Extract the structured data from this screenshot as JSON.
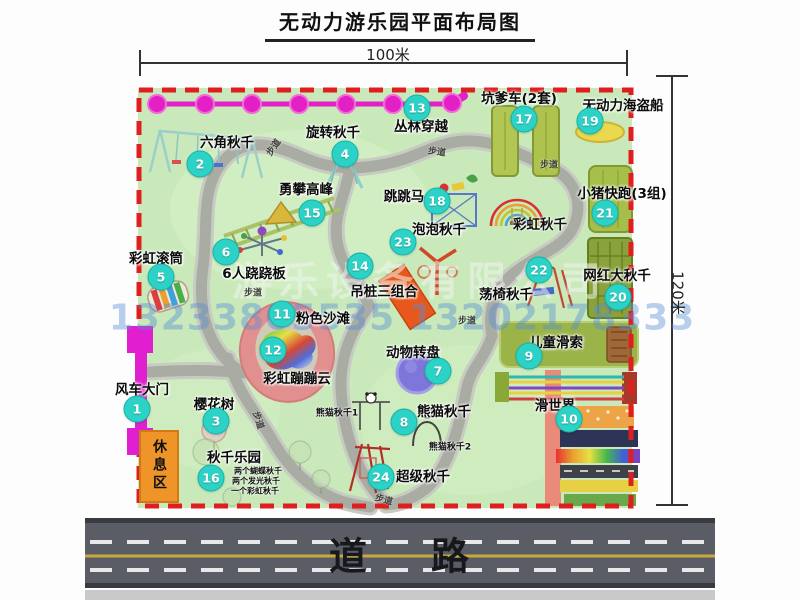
{
  "title": "无动力游乐园平面布局图",
  "dimensions": {
    "width_label": "100米",
    "height_label": "120米"
  },
  "watermark": {
    "company": "游乐设备有限公司",
    "phone": "13233805535 13202178333"
  },
  "road": {
    "label": "道路"
  },
  "colors": {
    "map_green": "#c9e9bb",
    "border_red": "#df1f1f",
    "badge_teal": "#2bd2c5",
    "zipline_pink": "#e320c6",
    "gate_magenta": "#e020d0",
    "rest_orange": "#ef9428",
    "path_gray": "#a8aca3",
    "road_gray": "#5b5d66"
  },
  "map": {
    "attractions": [
      {
        "num": 1,
        "name": "风车大门",
        "lx": 142,
        "ly": 388,
        "bx": 137,
        "by": 409
      },
      {
        "num": 2,
        "name": "六角秋千",
        "lx": 227,
        "ly": 141,
        "bx": 200,
        "by": 164
      },
      {
        "num": 3,
        "name": "樱花树",
        "lx": 214,
        "ly": 403,
        "bx": 216,
        "by": 421
      },
      {
        "num": 4,
        "name": "旋转秋千",
        "lx": 333,
        "ly": 131,
        "bx": 345,
        "by": 154
      },
      {
        "num": 5,
        "name": "彩虹滚筒",
        "lx": 156,
        "ly": 257,
        "bx": 161,
        "by": 277
      },
      {
        "num": 6,
        "name": "6人跷跷板",
        "lx": 254,
        "ly": 272,
        "bx": 226,
        "by": 252
      },
      {
        "num": 7,
        "name": "动物转盘",
        "lx": 413,
        "ly": 351,
        "bx": 438,
        "by": 371
      },
      {
        "num": 8,
        "name": "熊猫秋千",
        "lx": 444,
        "ly": 410,
        "bx": 404,
        "by": 422
      },
      {
        "num": 9,
        "name": "儿童滑索",
        "lx": 556,
        "ly": 341,
        "bx": 529,
        "by": 356
      },
      {
        "num": 10,
        "name": "滑世界",
        "lx": 555,
        "ly": 404,
        "bx": 569,
        "by": 419
      },
      {
        "num": 11,
        "name": "粉色沙滩",
        "lx": 323,
        "ly": 317,
        "bx": 282,
        "by": 314
      },
      {
        "num": 12,
        "name": "彩虹蹦蹦云",
        "lx": 297,
        "ly": 377,
        "bx": 273,
        "by": 350
      },
      {
        "num": 13,
        "name": "丛林穿越",
        "lx": 421,
        "ly": 125,
        "bx": 417,
        "by": 108
      },
      {
        "num": 14,
        "name": "吊桩三组合",
        "lx": 384,
        "ly": 290,
        "bx": 360,
        "by": 266
      },
      {
        "num": 15,
        "name": "勇攀高峰",
        "lx": 306,
        "ly": 188,
        "bx": 312,
        "by": 213
      },
      {
        "num": 16,
        "name": "秋千乐园",
        "lx": 234,
        "ly": 456,
        "bx": 211,
        "by": 478
      },
      {
        "num": 17,
        "name": "坑爹车(2套)",
        "lx": 519,
        "ly": 97,
        "bx": 524,
        "by": 119
      },
      {
        "num": 18,
        "name": "跳跳马",
        "lx": 404,
        "ly": 195,
        "bx": 437,
        "by": 201
      },
      {
        "num": 19,
        "name": "无动力海盗船",
        "lx": 623,
        "ly": 104,
        "bx": 590,
        "by": 121
      },
      {
        "num": 20,
        "name": "网红大秋千",
        "lx": 617,
        "ly": 274,
        "bx": 618,
        "by": 297
      },
      {
        "num": 21,
        "name": "小猪快跑(3组)",
        "lx": 622,
        "ly": 192,
        "bx": 605,
        "by": 213
      },
      {
        "num": 22,
        "name": "荡椅秋千",
        "lx": 506,
        "ly": 293,
        "bx": 539,
        "by": 270
      },
      {
        "num": 23,
        "name": "泡泡秋千",
        "lx": 439,
        "ly": 228,
        "bx": 403,
        "by": 242
      },
      {
        "num": 24,
        "name": "超级秋千",
        "lx": 423,
        "ly": 475,
        "bx": 381,
        "by": 477
      }
    ],
    "sub_labels": [
      {
        "text": "彩虹秋千",
        "x": 540,
        "y": 223,
        "size": 13.5
      },
      {
        "text": "熊猫秋千1",
        "x": 337,
        "y": 412,
        "size": 9
      },
      {
        "text": "熊猫秋千2",
        "x": 450,
        "y": 446,
        "size": 9
      },
      {
        "text": "两个蝴蝶秋千",
        "x": 258,
        "y": 471,
        "size": 8
      },
      {
        "text": "两个发光秋千",
        "x": 256,
        "y": 481,
        "size": 8
      },
      {
        "text": "一个彩虹秋千",
        "x": 255,
        "y": 491,
        "size": 8
      }
    ],
    "rest_area_label": "休息区",
    "path_labels": [
      {
        "text": "步道",
        "x": 273,
        "y": 147,
        "rot": -55
      },
      {
        "text": "步道",
        "x": 437,
        "y": 151,
        "rot": 8
      },
      {
        "text": "步道",
        "x": 549,
        "y": 164,
        "rot": 0
      },
      {
        "text": "步道",
        "x": 253,
        "y": 292,
        "rot": 0
      },
      {
        "text": "步道",
        "x": 467,
        "y": 320,
        "rot": 0
      },
      {
        "text": "步道",
        "x": 259,
        "y": 420,
        "rot": 72
      },
      {
        "text": "步道",
        "x": 384,
        "y": 499,
        "rot": 15
      }
    ]
  }
}
